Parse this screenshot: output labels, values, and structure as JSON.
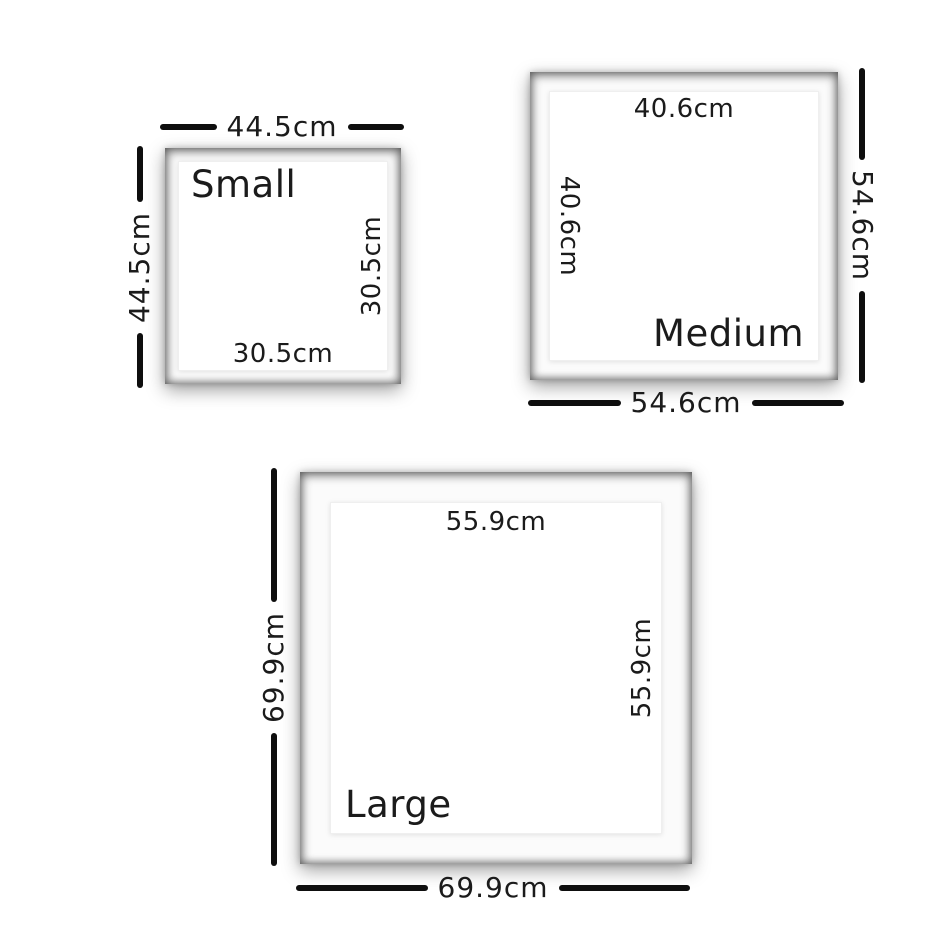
{
  "colors": {
    "frame": "#262626",
    "mat": "#fbfbfb",
    "print": "#ffffff",
    "line": "#0e0e0e",
    "text": "#1b1b1b",
    "background": "#ffffff"
  },
  "frames": [
    {
      "id": "small",
      "label": "Small",
      "outer_width": "44.5cm",
      "outer_height": "44.5cm",
      "inner_width": "30.5cm",
      "inner_height": "30.5cm"
    },
    {
      "id": "medium",
      "label": "Medium",
      "outer_width": "54.6cm",
      "outer_height": "54.6cm",
      "inner_width": "40.6cm",
      "inner_height": "40.6cm"
    },
    {
      "id": "large",
      "label": "Large",
      "outer_width": "69.9cm",
      "outer_height": "69.9cm",
      "inner_width": "55.9cm",
      "inner_height": "55.9cm"
    }
  ]
}
